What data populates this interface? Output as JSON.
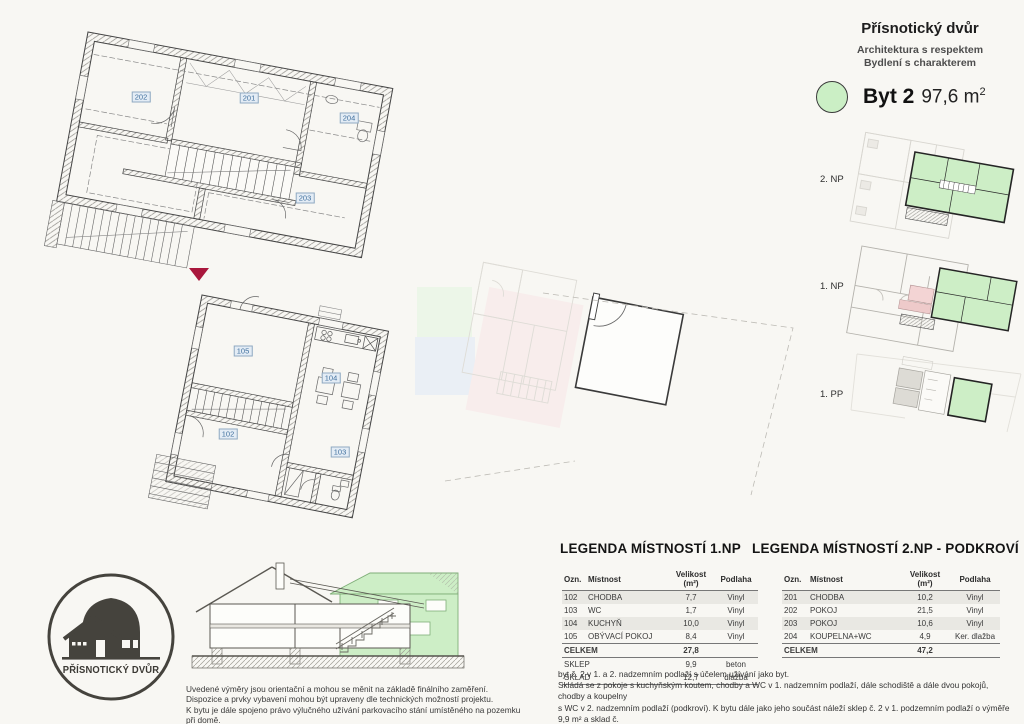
{
  "colors": {
    "accent_green": "#cdeec6",
    "label_blue": "#41709e",
    "arrow_red": "#a9173c",
    "plan_line": "#444444",
    "ghost_gray": "#d8d6d0",
    "table_stripe": "#e9e8e3",
    "background": "#f8f7f3"
  },
  "header": {
    "title": "Přísnotický dvůr",
    "subtitle1": "Architektura s respektem",
    "subtitle2": "Bydlení s charakterem",
    "apartment_name": "Byt 2",
    "apartment_area": "97,6 m",
    "apartment_area_sup": "2"
  },
  "floors": [
    {
      "label": "2. NP"
    },
    {
      "label": "1. NP"
    },
    {
      "label": "1. PP"
    }
  ],
  "plans": {
    "np2_rooms": [
      "202",
      "201",
      "204",
      "203"
    ],
    "np1_rooms": [
      "105",
      "104",
      "102",
      "103"
    ]
  },
  "legend1": {
    "title": "LEGENDA MÍSTNOSTÍ 1.NP",
    "headers": [
      "Ozn.",
      "Místnost",
      "Velikost (m²)",
      "Podlaha"
    ],
    "rows": [
      [
        "102",
        "CHODBA",
        "7,7",
        "Vinyl"
      ],
      [
        "103",
        "WC",
        "1,7",
        "Vinyl"
      ],
      [
        "104",
        "KUCHYŇ",
        "10,0",
        "Vinyl"
      ],
      [
        "105",
        "OBÝVACÍ POKOJ",
        "8,4",
        "Vinyl"
      ]
    ],
    "total_label": "CELKEM",
    "total_value": "27,8",
    "extra_rows": [
      [
        "SKLEP",
        "9,9",
        "beton"
      ],
      [
        "SKLAD",
        "12,7",
        "dlažba"
      ]
    ]
  },
  "legend2": {
    "title": "LEGENDA MÍSTNOSTÍ 2.NP - PODKROVÍ",
    "headers": [
      "Ozn.",
      "Místnost",
      "Velikost (m²)",
      "Podlaha"
    ],
    "rows": [
      [
        "201",
        "CHODBA",
        "10,2",
        "Vinyl"
      ],
      [
        "202",
        "POKOJ",
        "21,5",
        "Vinyl"
      ],
      [
        "203",
        "POKOJ",
        "10,6",
        "Vinyl"
      ],
      [
        "204",
        "KOUPELNA+WC",
        "4,9",
        "Ker. dlažba"
      ]
    ],
    "total_label": "CELKEM",
    "total_value": "47,2"
  },
  "logo": {
    "text": "PŘÍSNOTICKÝ DVŮR"
  },
  "disclaimer": {
    "line1": "Uvedené výměry jsou orientační a mohou se měnit na základě finálního zaměření.",
    "line2": "Dispozice a prvky vybavení mohou být upraveny dle technických možností projektu.",
    "line3": "K bytu je dále spojeno právo výlučného užívání parkovacího stání umístěného na pozemku při domě."
  },
  "description": {
    "line1": "byt č. 2 v 1. a 2. nadzemním podlaží s účelem užívání jako byt.",
    "line2": "Skládá se z pokoje s kuchyňským koutem, chodby a WC v 1. nadzemním podlaží, dále schodiště a dále dvou pokojů, chodby a koupelny",
    "line3": "s WC v 2. nadzemním podlaží (podkroví). K bytu dále jako jeho součást náleží sklep č. 2 v 1. podzemním podlaží o výměře 9,9 m² a sklad č.",
    "line4": "2 v dvorní budově v 1. nadzemním podlaží o výměře 12,7 m². ",
    "line4_bold": "Celková plocha bytu je 97,6 m²."
  }
}
